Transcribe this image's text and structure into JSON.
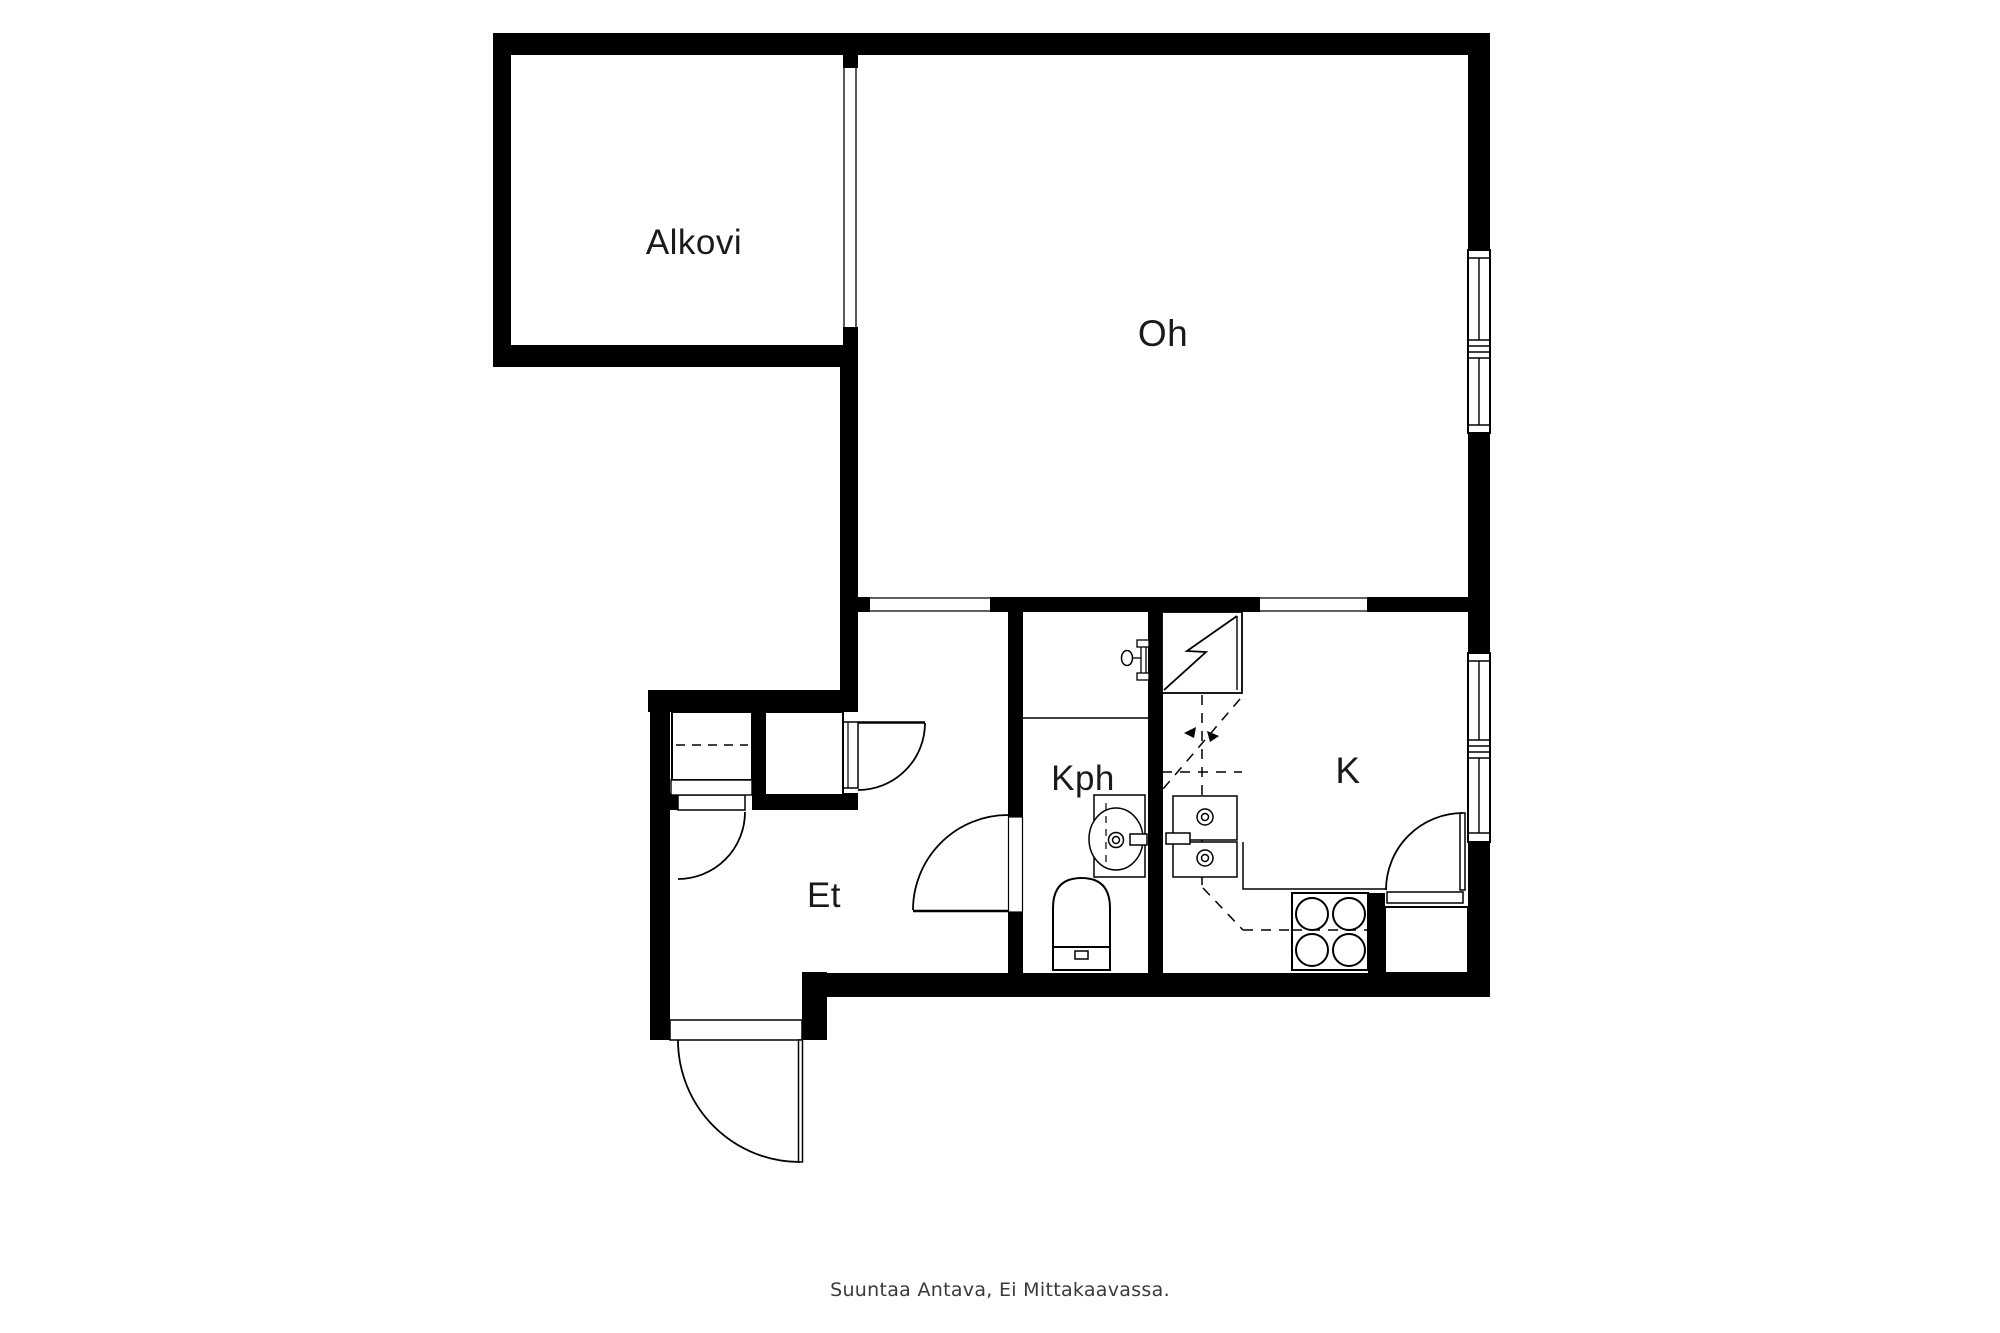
{
  "floorplan": {
    "rooms": {
      "alkovi": {
        "label": "Alkovi"
      },
      "oh": {
        "label": "Oh"
      },
      "kph": {
        "label": "Kph"
      },
      "k": {
        "label": "K"
      },
      "et": {
        "label": "Et"
      }
    },
    "footer": {
      "disclaimer": "Suuntaa Antava, Ei Mittakaavassa."
    },
    "colors": {
      "walls": "#000000",
      "lines": "#000000",
      "background": "#ffffff",
      "label_text": "#1a1a1a",
      "footer_text": "#3a3a3a"
    }
  }
}
